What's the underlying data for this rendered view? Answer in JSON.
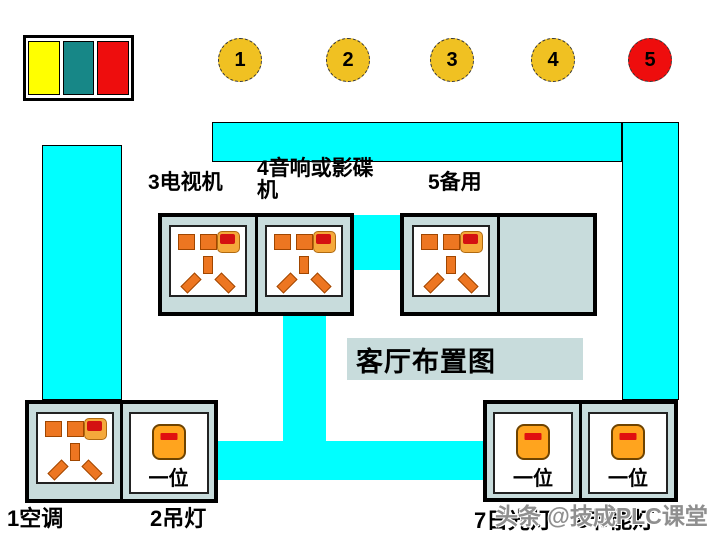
{
  "title": "客厅布置图",
  "legend": {
    "swatches": [
      {
        "name": "yellow",
        "color": "#FFFF00"
      },
      {
        "name": "teal",
        "color": "#178787"
      },
      {
        "name": "red",
        "color": "#EE0D0D"
      }
    ]
  },
  "circuit_markers": [
    {
      "label": "1",
      "color": "#F0C122"
    },
    {
      "label": "2",
      "color": "#F0C122"
    },
    {
      "label": "3",
      "color": "#F0C122"
    },
    {
      "label": "4",
      "color": "#F0C122"
    },
    {
      "label": "5",
      "color": "#EE0D0D"
    }
  ],
  "outlets": {
    "tv_label": "3电视机",
    "audio_label": "4音响或影碟机",
    "spare_label": "5备用",
    "aircon_label": "1空调",
    "chandelier_label": "2吊灯",
    "fluorescent_label": "7日光灯",
    "energy_label": "8节能灯"
  },
  "switch_text": "一位",
  "watermark": "头条 @技成PLC课堂",
  "colors": {
    "duct_cyan": "#00FFFF",
    "panel_bg": "#C8DCDC",
    "slot_orange": "#ED7621",
    "indicator_amber": "#F5A93B",
    "indicator_red": "#D41111",
    "switch_orange": "#FFA41E",
    "switch_bar_red": "#E01010"
  }
}
